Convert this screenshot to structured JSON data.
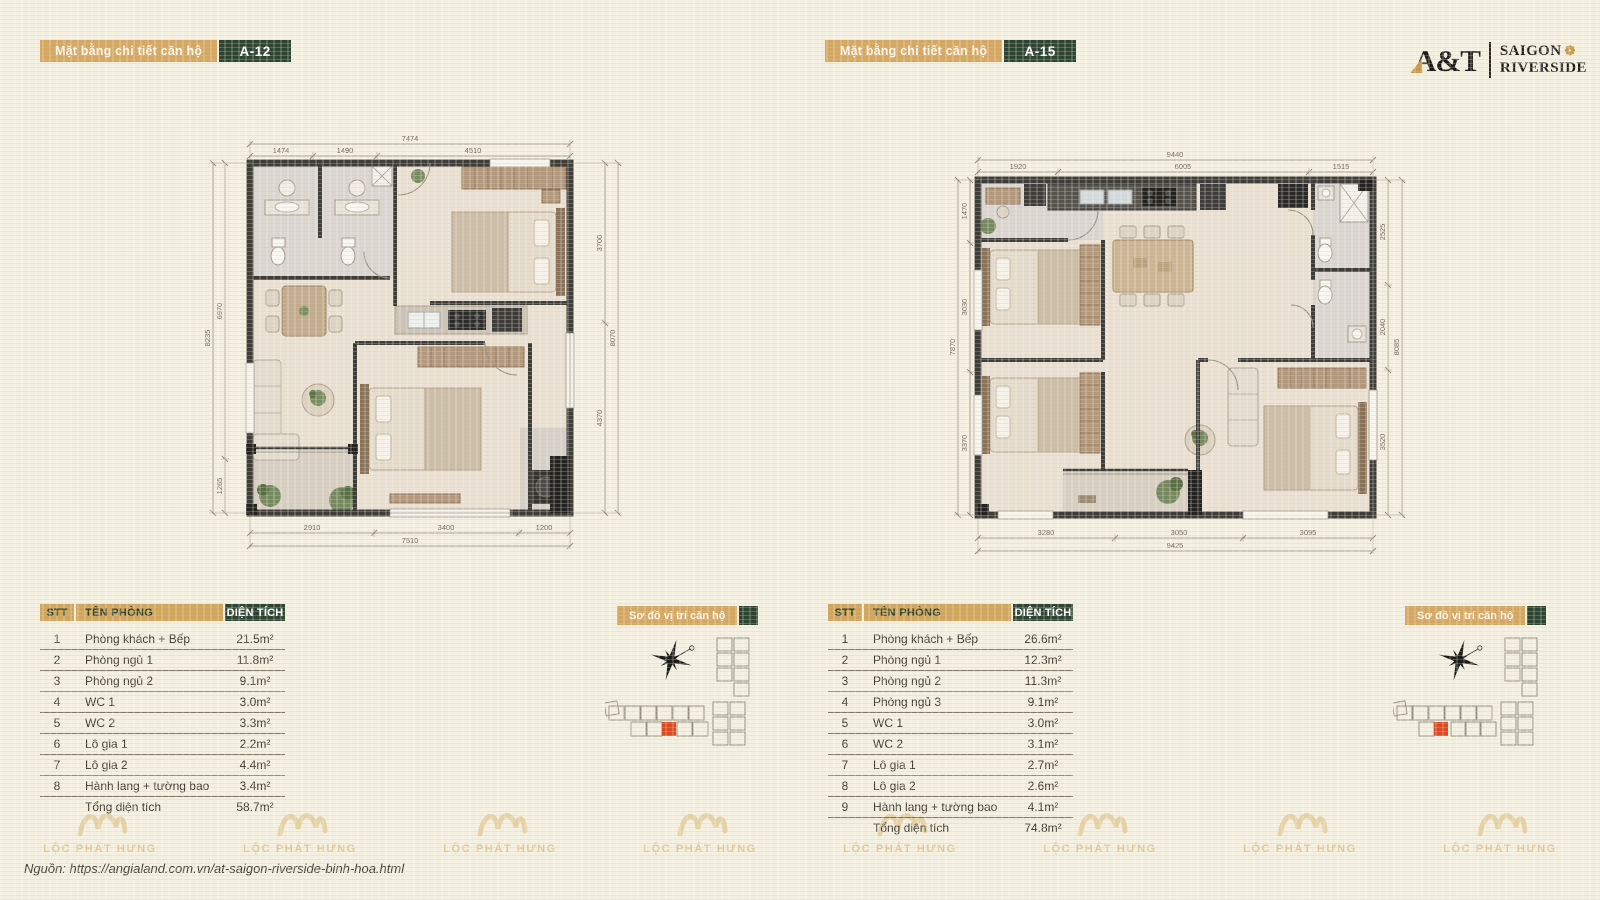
{
  "logo": {
    "brand": "A&T",
    "line1": "SAIGON",
    "line2": "RIVERSIDE"
  },
  "watermark_text": "LỘC PHÁT HƯNG",
  "source_note": "Nguồn:  https://angialand.com.vn/at-saigon-riverside-binh-hoa.html",
  "plans": [
    {
      "header_label": "Mặt bằng chi tiết căn hộ",
      "unit": "A-12",
      "location_label": "Sơ đồ vị trí căn hộ",
      "dims": {
        "top_total": "7474",
        "top_segments": [
          "1474",
          "1490",
          "4510"
        ],
        "bottom_segments": [
          "2910",
          "3400",
          "1200"
        ],
        "bottom_total": "7510",
        "left_total": "8235",
        "left_segments": [
          "6970",
          "1265"
        ],
        "right_segments": [
          "3700",
          "4370"
        ],
        "right_total": "8070"
      },
      "table": {
        "headers": {
          "stt": "STT",
          "name": "TÊN PHÒNG",
          "area": "DIỆN TÍCH"
        },
        "rows": [
          {
            "stt": "1",
            "name": "Phòng khách + Bếp",
            "area": "21.5m²"
          },
          {
            "stt": "2",
            "name": "Phòng ngủ 1",
            "area": "11.8m²"
          },
          {
            "stt": "3",
            "name": "Phòng ngủ 2",
            "area": "9.1m²"
          },
          {
            "stt": "4",
            "name": "WC 1",
            "area": "3.0m²"
          },
          {
            "stt": "5",
            "name": "WC 2",
            "area": "3.3m²"
          },
          {
            "stt": "6",
            "name": "Lô gia 1",
            "area": "2.2m²"
          },
          {
            "stt": "7",
            "name": "Lô gia 2",
            "area": "4.4m²"
          },
          {
            "stt": "8",
            "name": "Hành lang + tường bao",
            "area": "3.4m²"
          }
        ],
        "total_label": "Tổng diện tích",
        "total_area": "58.7m²"
      }
    },
    {
      "header_label": "Mặt bằng chi tiết căn hộ",
      "unit": "A-15",
      "location_label": "Sơ đồ vị trí căn hộ",
      "dims": {
        "top_total": "9440",
        "top_segments": [
          "1920",
          "6005",
          "1515"
        ],
        "bottom_segments": [
          "3280",
          "3050",
          "3095"
        ],
        "bottom_total": "9425",
        "left_total": "7870",
        "left_segments": [
          "1470",
          "3030",
          "3370"
        ],
        "right_segments": [
          "2525",
          "2040",
          "3520"
        ],
        "right_total": "8085"
      },
      "table": {
        "headers": {
          "stt": "STT",
          "name": "TÊN PHÒNG",
          "area": "DIỆN TÍCH"
        },
        "rows": [
          {
            "stt": "1",
            "name": "Phòng khách + Bếp",
            "area": "26.6m²"
          },
          {
            "stt": "2",
            "name": "Phòng ngủ 1",
            "area": "12.3m²"
          },
          {
            "stt": "3",
            "name": "Phòng ngủ 2",
            "area": "11.3m²"
          },
          {
            "stt": "4",
            "name": "Phòng ngủ 3",
            "area": "9.1m²"
          },
          {
            "stt": "5",
            "name": "WC 1",
            "area": "3.0m²"
          },
          {
            "stt": "6",
            "name": "WC 2",
            "area": "3.1m²"
          },
          {
            "stt": "7",
            "name": "Lô gia 1",
            "area": "2.7m²"
          },
          {
            "stt": "8",
            "name": "Lô gia 2",
            "area": "2.6m²"
          },
          {
            "stt": "9",
            "name": "Hành lang + tường bao",
            "area": "4.1m²"
          }
        ],
        "total_label": "Tổng diện tích",
        "total_area": "74.8m²"
      }
    }
  ]
}
